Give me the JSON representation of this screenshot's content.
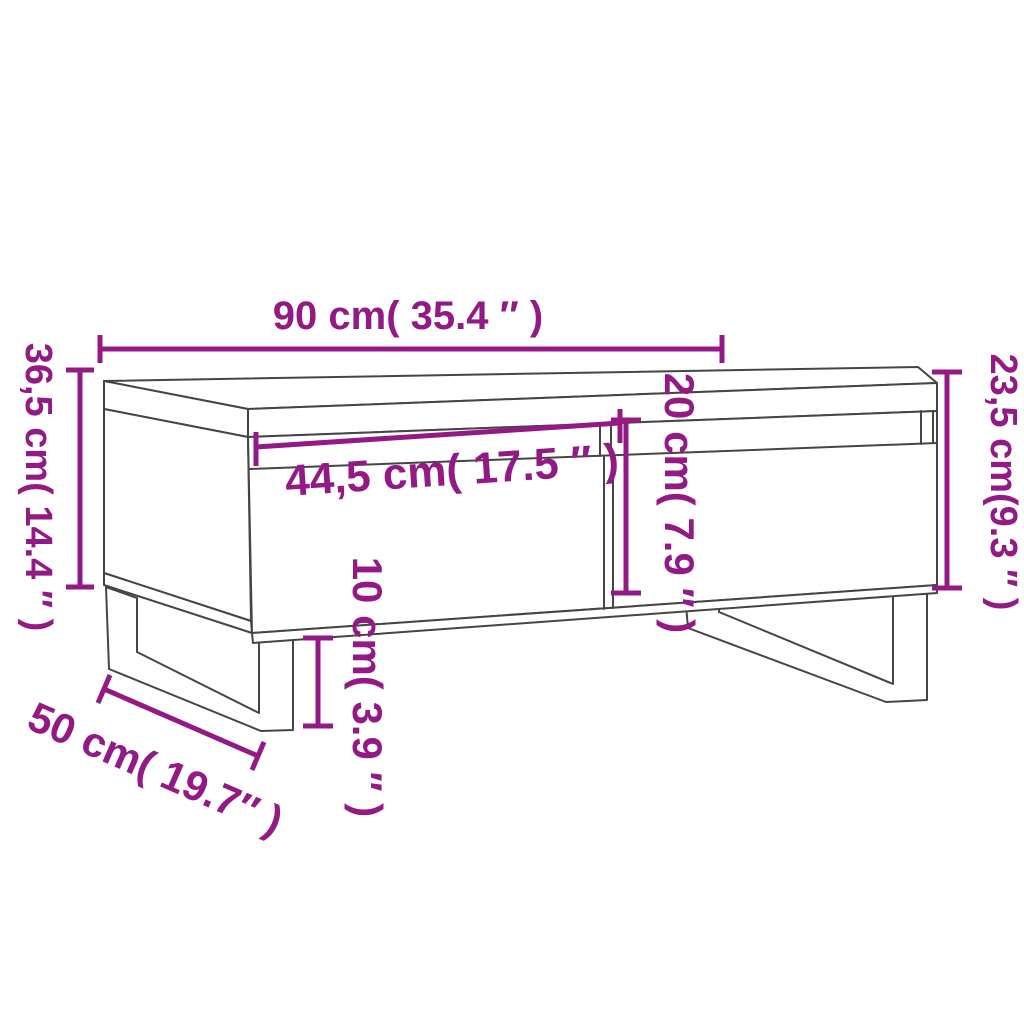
{
  "diagram": {
    "subject": "coffee-table-dimension-diagram",
    "accent_color": "#931A84",
    "line_color": "#454545",
    "labels": {
      "top_width": "90 cm( 35.4 ″ )",
      "left_height": "36,5 cm( 14.4 ″ )",
      "right_height": "23,5 cm(9.3 ″ )",
      "drawer_width": "44,5 cm( 17.5 ″ )",
      "compartment_height": "20 cm( 7.9 ″ )",
      "leg_height": "10 cm( 3.9 ″ )",
      "depth": "50 cm( 19.7″ )"
    }
  }
}
